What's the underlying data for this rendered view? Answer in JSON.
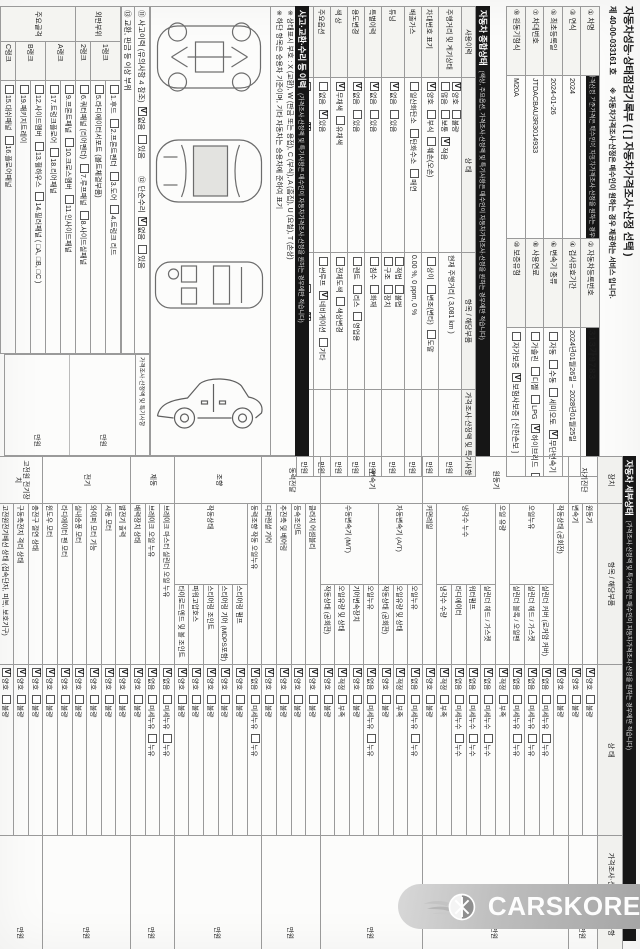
{
  "title": {
    "main": "자동차성능·상태점검기록부 ( [  ] 자동차가격조사·산정 선택 )",
    "doc_no": "제  40-00-033161  호",
    "service_note": "※ 자동차가격조사·산정은 매수인이 원하는 경우 제공하는 서비스 입니다."
  },
  "basic_info": {
    "bar": "자동차 기본정보",
    "note": "(가격산정 기준가격은 매수인이 자동차가격조사·산정을 원하는 경우에만 적습니다)",
    "rows": [
      [
        "#① 차명",
        "#도요타 Prius 2WD   (세부모델 : )",
        "#② 자동차등록번호",
        "!313가9783"
      ],
      [
        "#③ 연식",
        "#2024",
        "#④ 검사유효기간",
        "#2024년01월26일 ~ 2028년01월25일"
      ],
      [
        "#⑤ 최초등록일",
        "#2024-01-26",
        "#⑥ 변속기 종류",
        "자동|수동|세미오토|✓무단변속기|기타 (      )"
      ],
      [
        "#⑦ 차대번호",
        "#JTDACBAU3R3014933",
        "#⑧ 사용연료",
        "가솔린|디젤|LPG|✓하이브리드|전기|수소전기|기타"
      ],
      [
        "#⑨ 원동기형식",
        "#M20A",
        "#⑩ 보증유형",
        "자가보증|✓보험사보증 [ 신한손보 ]",
        "#가격산정 기준가격",
        "#만원"
      ]
    ]
  },
  "overall_status": {
    "bar": "자동차 종합상태",
    "note": "(색상, 주요옵션, 가격조사·산정액 및 특기사항은 매수인이 자동차가격조사·산정을 원하는 경우에만 적습니다)",
    "headers": [
      "사용이력",
      "상     태",
      "항목 / 해당부품",
      "가격조사·산정액 및 특기사항"
    ],
    "rows": [
      {
        "label": "주행거리 및 계기상태",
        "state": [
          "✓양호|불량",
          "많음|보통|✓적음"
        ],
        "item": [
          "#현재 주행거리 (  3,081 km  )"
        ],
        "price": "만원"
      },
      {
        "label": "차대번호 표기",
        "state": [
          "✓양호|부식|훼손(오손)"
        ],
        "item": [
          "상이|변조(변타)|도말"
        ],
        "price": "만원"
      },
      {
        "label": "배출가스",
        "state": [
          "일산화탄소|탄화수소|매연"
        ],
        "item": [
          "#0.00 %,   0 ppm,   0 %"
        ],
        "price": "만원"
      },
      {
        "label": "튜닝",
        "state": [
          "✓없음|있음"
        ],
        "item": [
          "적법|불법",
          "구조|장치"
        ],
        "price": "만원"
      },
      {
        "label": "특별이력",
        "state": [
          "✓없음|있음"
        ],
        "item": [
          "침수|화재"
        ],
        "price": "만원"
      },
      {
        "label": "용도변경",
        "state": [
          "✓없음|있음"
        ],
        "item": [
          "렌트|리스|영업용"
        ],
        "price": "만원"
      },
      {
        "label": "색  상",
        "state": [
          "✓무채색|유채색"
        ],
        "item": [
          "전체도색|색상변경"
        ],
        "price": "만원"
      },
      {
        "label": "주요옵션",
        "state": [
          "없음|✓있음"
        ],
        "item": [
          "썬루프|✓네비게이션|기타"
        ],
        "price": "만원"
      },
      {
        "label": "리콜대상",
        "state": [
          "해당없음|✓해당"
        ],
        "item": [
          "리콜이행::이행|✓미이행"
        ],
        "price": "만원"
      }
    ]
  },
  "accident_history": {
    "bar": "사고·교환·수리 등 이력",
    "note": "(가격조사·산정액 및 특기사항은 매수인이 자동차가격조사·산정을 원하는 경우에만 적습니다)",
    "legend_notes": [
      "※ 상태표시 부호 : X (교환), W (판금 또는 용접), C (부식), A (흠집), U (요철), T (손상)",
      "※ 하단 항목은 승용차 기준이며, 기타 자동차는 승용차에 준하여 표기"
    ],
    "history_items": [
      "⑪ 사고이력 (유의사항 4 참조)::✓없음|있음",
      "⑫ 단순수리::✓없음|있음"
    ],
    "exchange_label": "⑬ 교환, 판금 등 이상 부위",
    "diagram_views": [
      "underbody-frame-view",
      "roof-top-view",
      "cabin-top-view",
      "side-view"
    ],
    "exterior": {
      "label": "외판부위",
      "ranks": [
        {
          "rank": "1랭크",
          "lines": [
            "1.후드|2.프론트펜더|3.도어|4.트렁크 리드",
            "5.라디에이터서포트 (볼트체결부품)"
          ]
        },
        {
          "rank": "2랭크",
          "lines": [
            "6.쿼터패널 (리어펜더)|7.루프패널|8.사이드실패널"
          ]
        }
      ]
    },
    "frame": {
      "label": "주요골격",
      "ranks": [
        {
          "rank": "A랭크",
          "lines": [
            "9.프론트패널|10.크로스멤버|11.인사이드패널",
            "17.트렁크플로어|18.리어패널"
          ]
        },
        {
          "rank": "B랭크",
          "lines": [
            "12.사이드멤버|13.휠하우스|14.필러패널 ( □A, □B, □C )",
            "19.패키지트레이"
          ]
        },
        {
          "rank": "C랭크",
          "lines": [
            "15.대쉬패널|16.플로어패널"
          ]
        }
      ]
    },
    "price_header": "가격조사·산정액 및 특기사항",
    "price_cells": [
      "만원",
      "만원"
    ]
  },
  "detail_status": {
    "bar": "자동차 세부상태",
    "note": "(가격조사·산정액 및 특기사항은 매수인이 자동차가격조사·산정을 원하는 경우에만 적습니다)",
    "headers": [
      "장치",
      "항목 / 해당부품",
      "상     태",
      "가격조사·산정액 및 특기사항"
    ],
    "groups": [
      {
        "name": "자기진단",
        "price": "만원",
        "rows": [
          {
            "item": "원동기",
            "part": "",
            "opts": "✓양호|불량"
          },
          {
            "item": "변속기",
            "part": "",
            "opts": "✓양호|불량"
          }
        ]
      },
      {
        "name": "원동기",
        "price": "만원",
        "rows": [
          {
            "item": "작동상태 (공회전)",
            "part": "",
            "opts": "✓양호|불량"
          },
          {
            "item": "오일누유",
            "part": "실린더 커버 (로커암 커버)",
            "opts": "✓없음|미세누유|누유"
          },
          {
            "item": "",
            "part": "실린더 헤드 / 가스켓",
            "opts": "✓없음|미세누유|누유"
          },
          {
            "item": "",
            "part": "실린더 블록 / 오일팬",
            "opts": "✓없음|미세누유|누유"
          },
          {
            "item": "오일 유량",
            "part": "",
            "opts": "✓적정|부족"
          },
          {
            "item": "냉각수 누수",
            "part": "실린더 헤드 / 가스켓",
            "opts": "✓없음|미세누수|누수"
          },
          {
            "item": "",
            "part": "워터펌프",
            "opts": "✓없음|미세누수|누수"
          },
          {
            "item": "",
            "part": "라디에이터",
            "opts": "✓없음|미세누수|누수"
          },
          {
            "item": "",
            "part": "냉각수 수량",
            "opts": "✓적정|부족"
          },
          {
            "item": "커먼레일",
            "part": "",
            "opts": "✓양호|불량"
          }
        ]
      },
      {
        "name": "변속기",
        "price": "만원",
        "rows": [
          {
            "item": "자동변속기 (A/T)",
            "part": "오일누유",
            "opts": "✓없음|미세누유|누유"
          },
          {
            "item": "",
            "part": "오일유량 및 상태",
            "opts": "✓적정|부족"
          },
          {
            "item": "",
            "part": "작동상태 (공회전)",
            "opts": "✓양호|불량"
          },
          {
            "item": "수동변속기 (M/T)",
            "part": "오일누유",
            "opts": "✓없음|미세누유|누유"
          },
          {
            "item": "",
            "part": "기어변속장치",
            "opts": "✓양호|불량"
          },
          {
            "item": "",
            "part": "오일유량 및 상태",
            "opts": "✓적정|부족"
          },
          {
            "item": "",
            "part": "작동상태 (공회전)",
            "opts": "✓양호|불량"
          }
        ]
      },
      {
        "name": "동력전달",
        "price": "만원",
        "rows": [
          {
            "item": "클러치 어셈블리",
            "part": "",
            "opts": "✓양호|불량"
          },
          {
            "item": "등속조인트",
            "part": "",
            "opts": "✓양호|불량"
          },
          {
            "item": "추진축 및 베어링",
            "part": "",
            "opts": "✓양호|불량"
          },
          {
            "item": "디퍼렌셜 기어",
            "part": "",
            "opts": "✓양호|불량"
          }
        ]
      },
      {
        "name": "조향",
        "price": "만원",
        "rows": [
          {
            "item": "동력조향 작동 오일누유",
            "part": "",
            "opts": "✓없음|미세누유|누유"
          },
          {
            "item": "작동상태",
            "part": "스티어링 펌프",
            "opts": "✓양호|불량"
          },
          {
            "item": "",
            "part": "스티어링 기어 (MDPS포함)",
            "opts": "✓양호|불량"
          },
          {
            "item": "",
            "part": "스티어링 조인트",
            "opts": "✓양호|불량"
          },
          {
            "item": "",
            "part": "파워고압호스",
            "opts": "✓양호|불량"
          },
          {
            "item": "",
            "part": "타이로드엔드 및 볼 조인트",
            "opts": "✓양호|불량"
          }
        ]
      },
      {
        "name": "제동",
        "price": "만원",
        "rows": [
          {
            "item": "브레이크 마스터 실린더 오일 누유",
            "part": "",
            "opts": "✓없음|미세누유|누유"
          },
          {
            "item": "브레이크 오일 누유",
            "part": "",
            "opts": "✓없음|미세누유|누유"
          },
          {
            "item": "배력장치 상태",
            "part": "",
            "opts": "✓양호|불량"
          }
        ]
      },
      {
        "name": "전기",
        "price": "만원",
        "rows": [
          {
            "item": "발전기 출력",
            "part": "",
            "opts": "✓양호|불량"
          },
          {
            "item": "시동 모터",
            "part": "",
            "opts": "✓양호|불량"
          },
          {
            "item": "와이퍼 모터 기능",
            "part": "",
            "opts": "✓양호|불량"
          },
          {
            "item": "실내송풍 모터",
            "part": "",
            "opts": "✓양호|불량"
          },
          {
            "item": "라디에이터 팬 모터",
            "part": "",
            "opts": "✓양호|불량"
          },
          {
            "item": "윈도우 모터",
            "part": "",
            "opts": "✓양호|불량"
          }
        ]
      },
      {
        "name": "고전원 전기장치",
        "price": "만원",
        "rows": [
          {
            "item": "충전구 절연 상태",
            "part": "",
            "opts": "✓양호|불량"
          },
          {
            "item": "구동축전지 격리 상태",
            "part": "",
            "opts": "✓양호|불량"
          },
          {
            "item": "고전원전기배선 상태 (접속단자, 피복, 보호기구)",
            "part": "",
            "opts": "✓양호|불량"
          }
        ]
      },
      {
        "name": "연료",
        "price": "만원",
        "rows": [
          {
            "item": "연료누출 (LP가스 포함)",
            "part": "",
            "opts": "✓없음|있음"
          }
        ]
      }
    ]
  },
  "watermark": {
    "text": "CARSKOREA",
    "icon": "flame-wheel-logo"
  }
}
